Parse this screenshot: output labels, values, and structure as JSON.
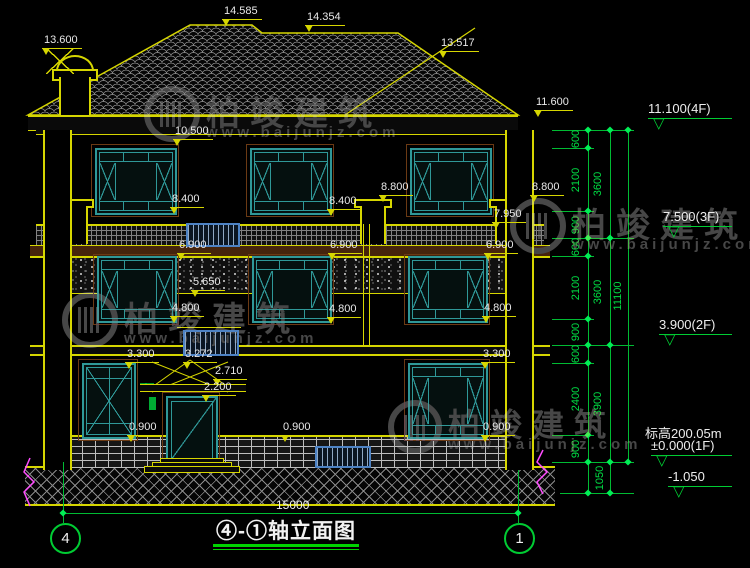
{
  "title": {
    "text": "④-①轴立面图"
  },
  "watermark": {
    "brand": "柏竣建筑",
    "site": "www.baijunjz.com"
  },
  "axis": {
    "left": "4",
    "right": "1"
  },
  "dims": {
    "overall_width": "15000"
  },
  "labels": [
    "13.600",
    "14.585",
    "14.354",
    "13.517",
    "11.600",
    "10.500",
    "8.400",
    "8.400",
    "8.800",
    "8.800",
    "7.950",
    "6.900",
    "6.900",
    "6.900",
    "5.650",
    "4.800",
    "4.800",
    "4.800",
    "3.300",
    "3.300",
    "3.272",
    "2.710",
    "2.200",
    "0.900",
    "0.900",
    "0.900"
  ],
  "chain": {
    "col1": [
      "600",
      "2100",
      "900",
      "600",
      "2100",
      "900",
      "600",
      "2400",
      "900"
    ],
    "col1_extra": "1050",
    "col2": [
      "3600",
      "3600",
      "3900"
    ],
    "col3": "11100"
  },
  "markers": [
    {
      "label": "11.100(4F)"
    },
    {
      "label": "7.500(3F)"
    },
    {
      "label": "3.900(2F)"
    },
    {
      "note": "标高200.05m",
      "label": "±0.000(1F)"
    },
    {
      "label": "-1.050"
    }
  ]
}
